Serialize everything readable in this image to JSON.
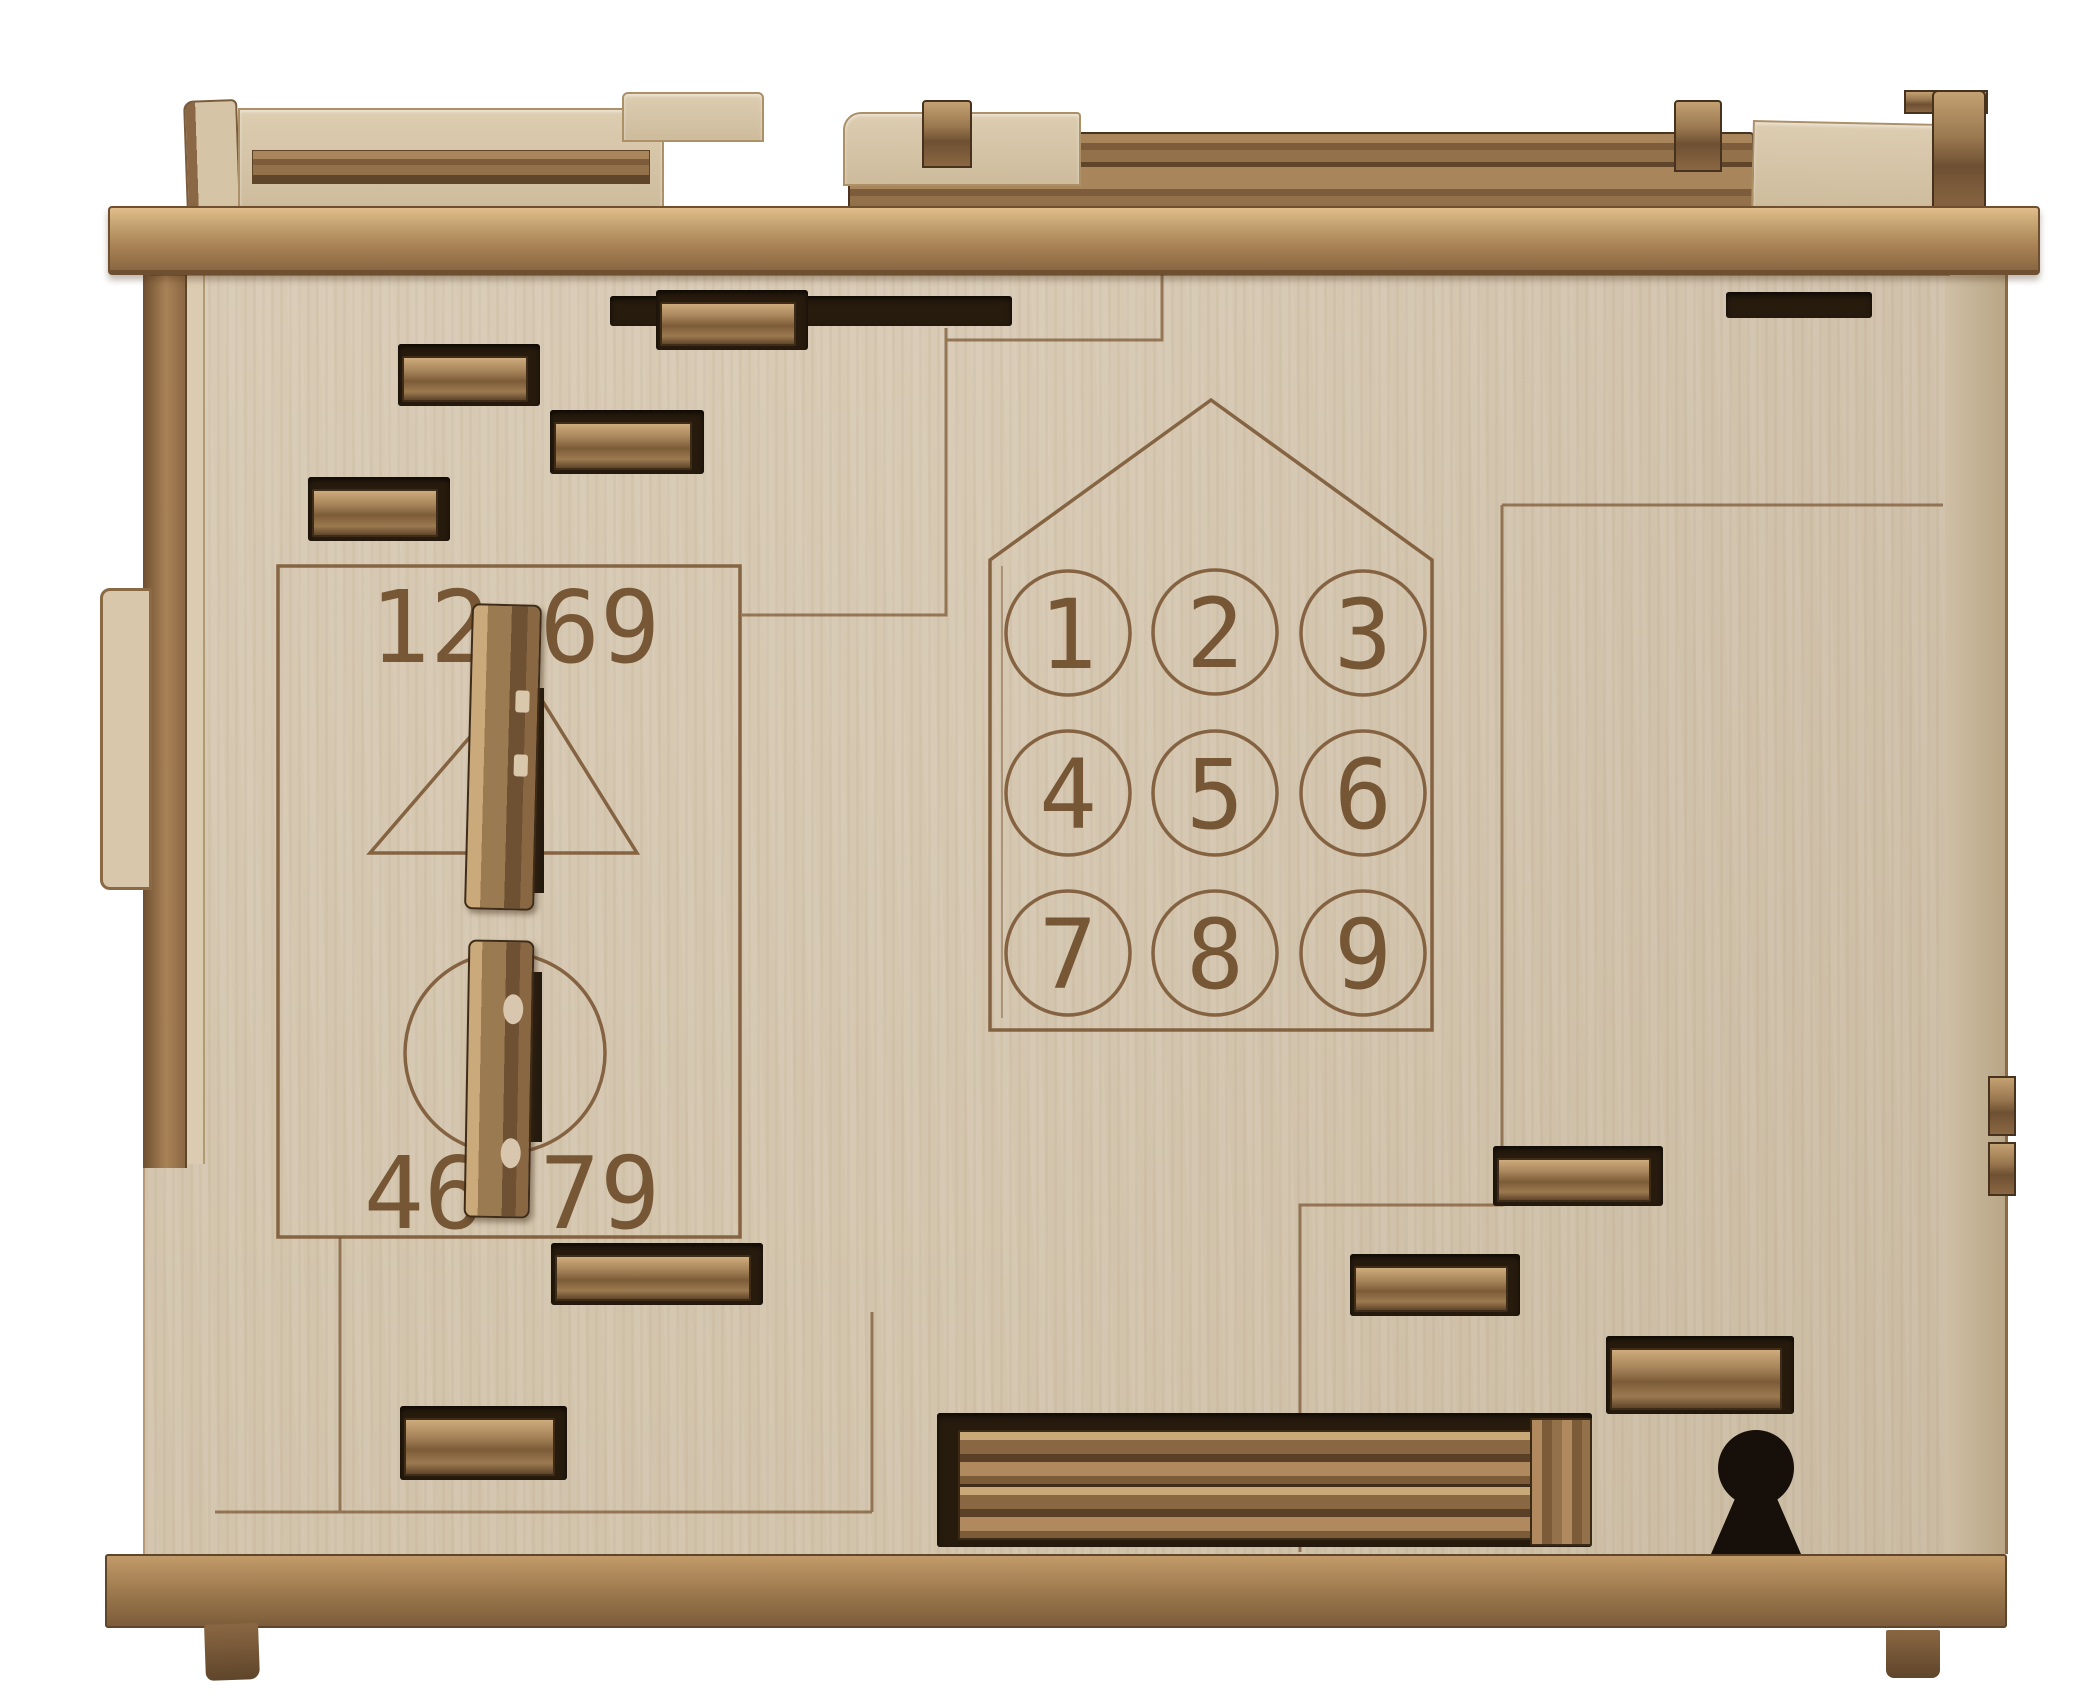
{
  "scene": {
    "subject": "Laser-cut wooden puzzle box, front view",
    "background_color": "#ffffff"
  },
  "palette": {
    "plywood_face": "#d6c8b2",
    "stained_wood": "#8a6743",
    "dark_slot": "#271b0e",
    "engraving_line": "#7a5633",
    "lid_wood": "#aa8355"
  },
  "dial_panel": {
    "top_left": "12",
    "top_right": "69",
    "bottom_left": "46",
    "bottom_right": "79"
  },
  "keypad": {
    "digits": [
      "1",
      "2",
      "3",
      "4",
      "5",
      "6",
      "7",
      "8",
      "9"
    ]
  }
}
